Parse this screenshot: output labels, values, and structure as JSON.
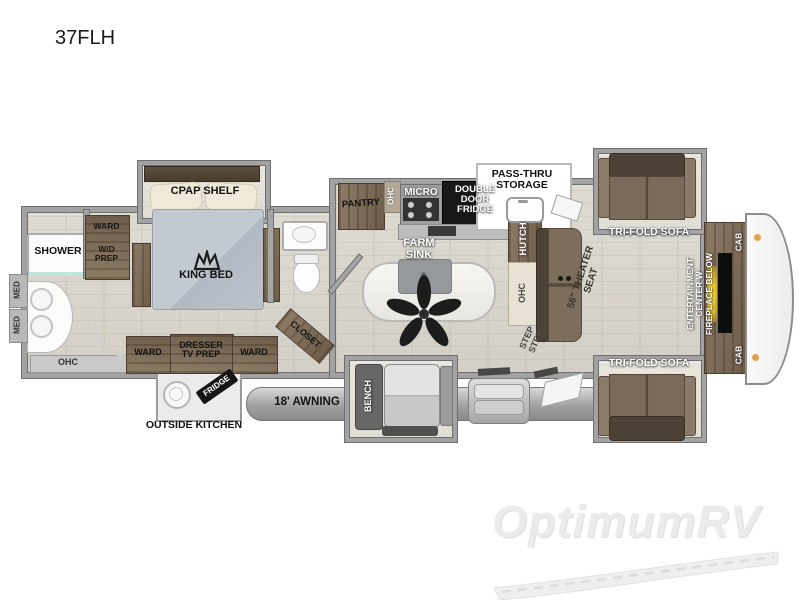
{
  "title": "37FLH",
  "watermark": {
    "brand": "OptimumRV"
  },
  "front_bath": {
    "shower": "SHOWER",
    "med": "MED",
    "ohc": "OHC"
  },
  "bedroom": {
    "cpap_shelf": "CPAP SHELF",
    "king_bed": "KING BED",
    "ward": "WARD",
    "wd_prep": "W/D\nPREP",
    "dresser_tv": "DRESSER\nTV PREP",
    "closet": "CLOSET"
  },
  "kitchen": {
    "pantry": "PANTRY",
    "ohc": "OHC",
    "micro": "MICRO",
    "fridge": "DOUBLE\nDOOR\nFRIDGE",
    "farm_sink": "FARM\nSINK"
  },
  "living": {
    "pass_thru": "PASS-THRU\nSTORAGE",
    "hutch": "HUTCH",
    "ohc": "OHC",
    "steps": "STEP\nSTEP",
    "theater_seat": "56\" THEATER\nSEAT",
    "tri_fold_sofa": "TRI-FOLD SOFA",
    "entertainment": "ENTERTAINMENT\nCENTER W\nFIREPLACE BELOW",
    "cab": "CAB"
  },
  "exterior": {
    "awning": "18' AWNING",
    "outside_kitchen": "OUTSIDE KITCHEN",
    "fridge": "FRIDGE",
    "bench": "BENCH"
  }
}
